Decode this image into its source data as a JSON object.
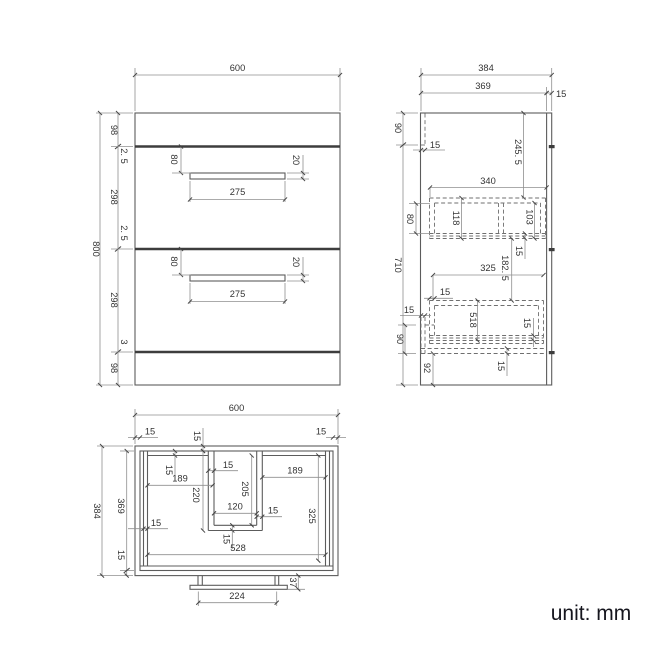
{
  "unit_label": "unit: mm",
  "front": {
    "width": "600",
    "height": "800",
    "top_rail": "98",
    "gap_small": "2. 5",
    "drawer_front": "298",
    "gap_bottom": "3",
    "bottom_rail": "98",
    "handle_offset": "80",
    "handle_width": "275",
    "handle_height": "20"
  },
  "side": {
    "depth": "384",
    "inner_depth": "369",
    "back_panel": "15",
    "top_section": "90",
    "rail_width": "15",
    "body_height": "710",
    "basin_depth": "245. 5",
    "drawer1_depth": "340",
    "drawer1_offset": "80",
    "drawer1_height": "118",
    "drawer1_inner_height": "103",
    "panel_15": "15",
    "drawer_gap": "182. 5",
    "drawer2_depth": "325",
    "drawer2_width": "518",
    "bottom_section": "90",
    "plinth_height": "92"
  },
  "plan": {
    "width": "600",
    "depth": "384",
    "inner_depth": "369",
    "wall": "15",
    "left_bay_width": "189",
    "recess_depth_outer": "220",
    "recess_depth_inner": "205",
    "recess_width": "120",
    "right_bay_width": "189",
    "right_bay_depth": "325",
    "inner_width": "528",
    "plinth_depth": "37",
    "plinth_width": "224"
  }
}
